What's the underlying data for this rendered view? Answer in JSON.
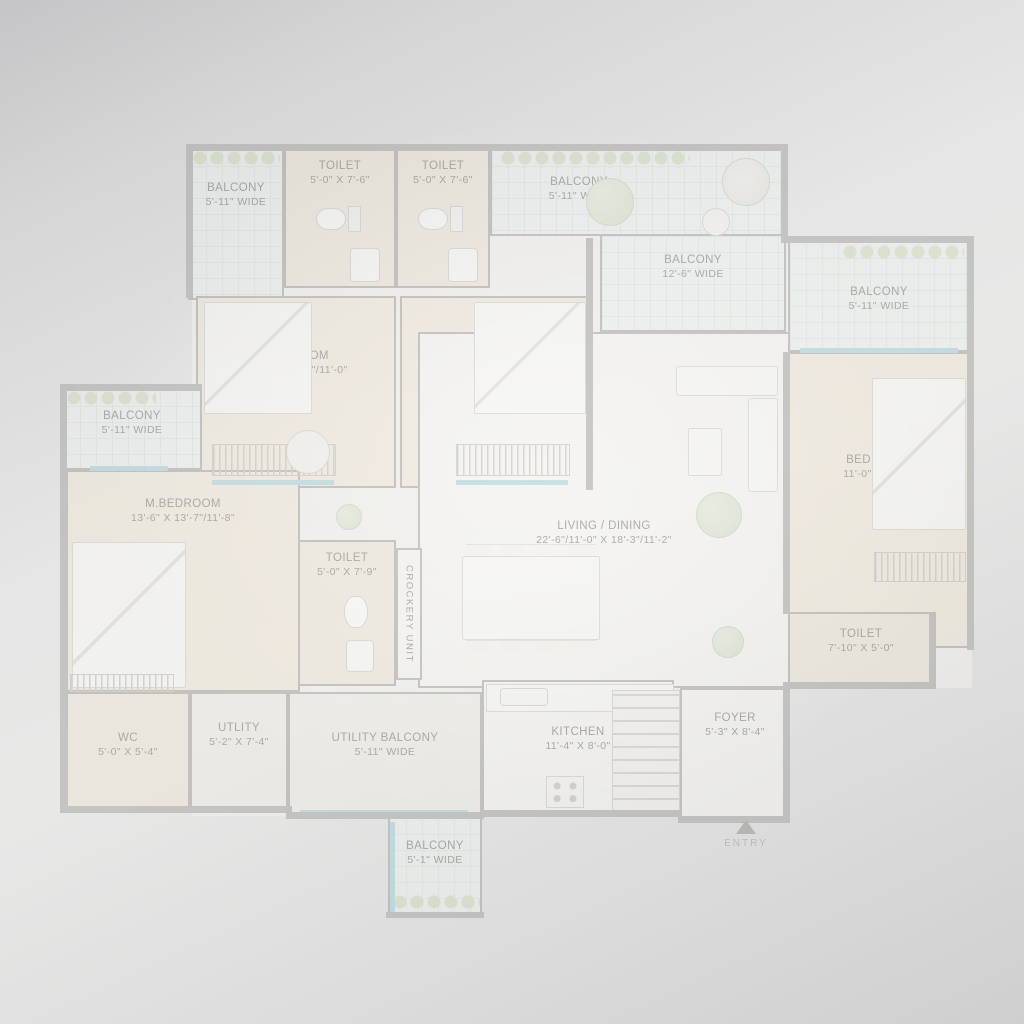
{
  "plan": {
    "entry_label": "ENTRY",
    "rooms": [
      {
        "id": "balcony-top-left",
        "name": "BALCONY",
        "dims": "5'-11\" WIDE"
      },
      {
        "id": "toilet-top-1",
        "name": "TOILET",
        "dims": "5'-0\" X 7'-6\""
      },
      {
        "id": "toilet-top-2",
        "name": "TOILET",
        "dims": "5'-0\" X 7'-6\""
      },
      {
        "id": "balcony-top-middle",
        "name": "BALCONY",
        "dims": "5'-11\" WIDE"
      },
      {
        "id": "balcony-top-wide",
        "name": "BALCONY",
        "dims": "12'-6\" WIDE"
      },
      {
        "id": "balcony-right",
        "name": "BALCONY",
        "dims": "5'-11\" WIDE"
      },
      {
        "id": "bed-room-1",
        "name": "BED ROOM",
        "dims": "11'-0\" X 13'-4\"/11'-0\""
      },
      {
        "id": "bed-room-2",
        "name": "BED ROOM",
        "dims": "11'-0\" X 13'-4\"/11'-0\""
      },
      {
        "id": "balcony-left",
        "name": "BALCONY",
        "dims": "5'-11\" WIDE"
      },
      {
        "id": "m-bedroom",
        "name": "M.BEDROOM",
        "dims": "13'-6\" X 13'-7\"/11'-8\""
      },
      {
        "id": "living-dining",
        "name": "LIVING / DINING",
        "dims": "22'-6\"/11'-0\" X 18'-3\"/11'-2\""
      },
      {
        "id": "bed-room-3",
        "name": "BED ROOM",
        "dims": "11'-0\" X 13'-0\""
      },
      {
        "id": "toilet-master",
        "name": "TOILET",
        "dims": "5'-0\" X 7'-9\""
      },
      {
        "id": "crockery-unit",
        "name": "CROCKERY UNIT",
        "dims": ""
      },
      {
        "id": "toilet-right",
        "name": "TOILET",
        "dims": "7'-10\" X 5'-0\""
      },
      {
        "id": "wc",
        "name": "WC",
        "dims": "5'-0\" X 5'-4\""
      },
      {
        "id": "utility",
        "name": "UTLITY",
        "dims": "5'-2\" X 7'-4\""
      },
      {
        "id": "utility-balcony",
        "name": "UTILITY BALCONY",
        "dims": "5'-11\" WIDE"
      },
      {
        "id": "kitchen",
        "name": "KITCHEN",
        "dims": "11'-4\" X 8'-0\""
      },
      {
        "id": "foyer",
        "name": "FOYER",
        "dims": "5'-3\" X 8'-4\""
      },
      {
        "id": "balcony-bottom",
        "name": "BALCONY",
        "dims": "5'-1\" WIDE"
      }
    ],
    "colors": {
      "background_gray": "#dedede",
      "wall_gray": "#c6c5c3",
      "room_beige": "#ece6da",
      "balcony_tint": "#e9f0ec",
      "window_blue": "#bfd9dc",
      "plant_green": "#dde3d3",
      "label_gray": "#b2b0ad"
    }
  }
}
